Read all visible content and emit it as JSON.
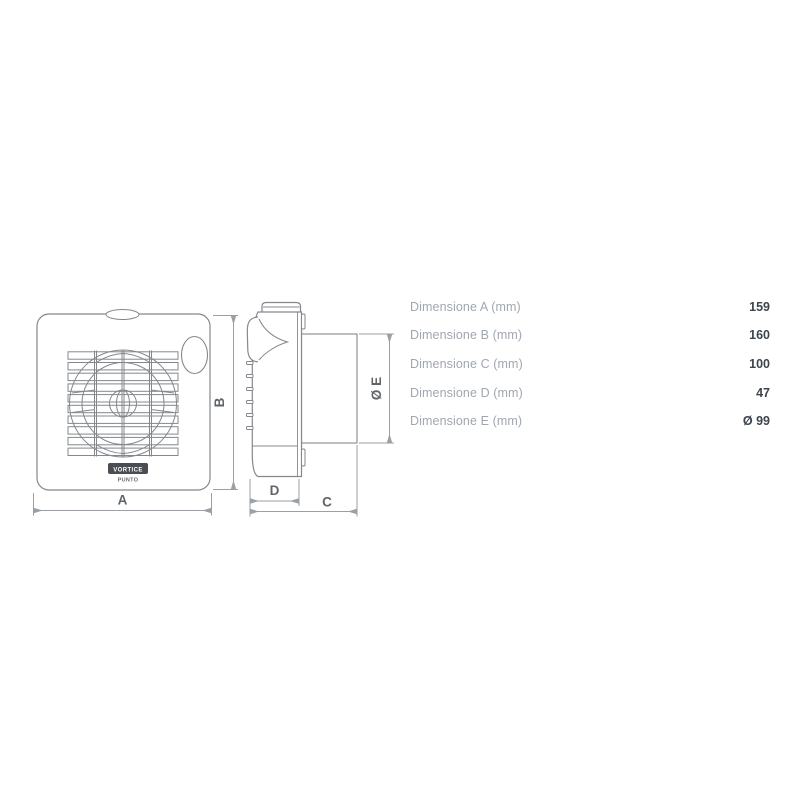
{
  "diagram": {
    "front_view": {
      "dim_a_label": "A",
      "dim_b_label": "B",
      "logo_brand": "VORTICE",
      "logo_model": "PUNTO"
    },
    "side_view": {
      "dim_c_label": "C",
      "dim_d_label": "D",
      "dim_e_label": "Ø E"
    }
  },
  "table": {
    "rows": [
      {
        "label": "Dimensione A (mm)",
        "value": "159"
      },
      {
        "label": "Dimensione B (mm)",
        "value": "160"
      },
      {
        "label": "Dimensione C (mm)",
        "value": "100"
      },
      {
        "label": "Dimensione D (mm)",
        "value": "47"
      },
      {
        "label": "Dimensione E (mm)",
        "value": "Ø 99"
      }
    ]
  },
  "colors": {
    "drawing_line": "#84888c",
    "dimension_line": "#9aa0a5",
    "dimension_text": "#60656a",
    "table_label": "#a1a7af",
    "table_value": "#3e444c",
    "logo_badge": "#4a4e53"
  }
}
